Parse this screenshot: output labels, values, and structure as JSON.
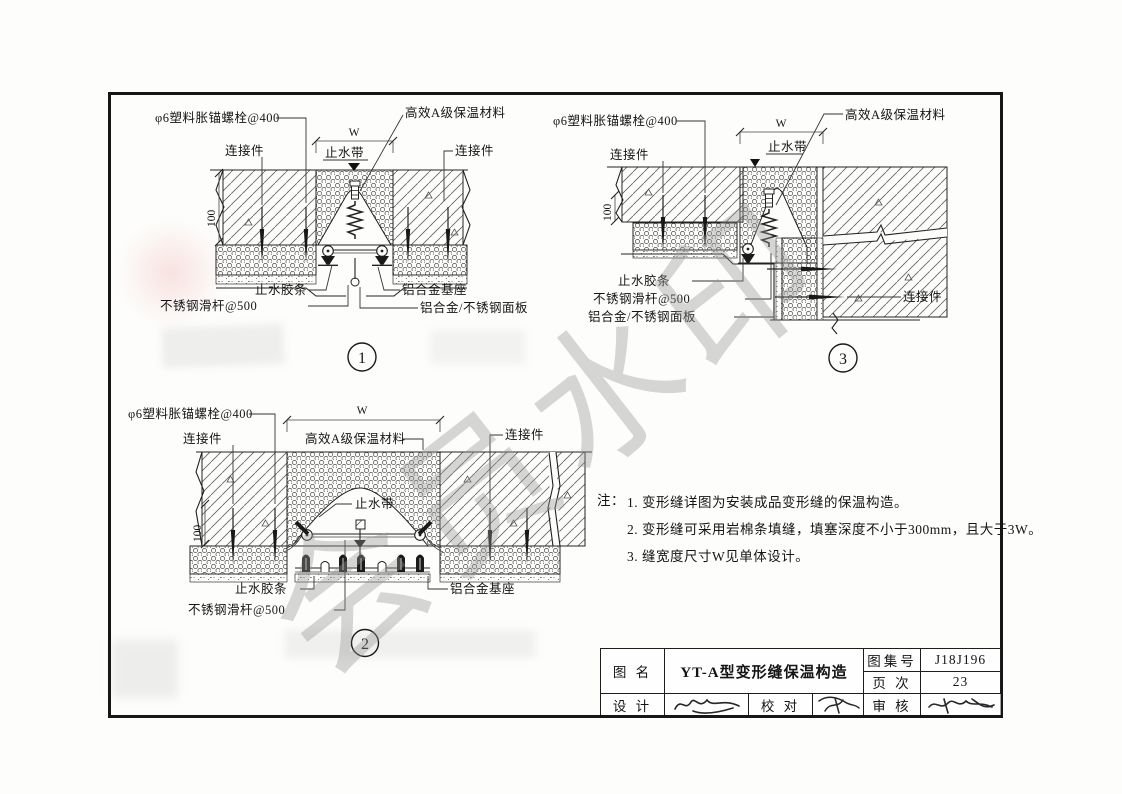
{
  "watermark_text": "会员水印",
  "labels": {
    "anchor_bolt": "φ6塑料胀锚螺栓@400",
    "connector": "连接件",
    "insulation": "高效A级保温材料",
    "waterstop_band": "止水带",
    "seal_strip": "止水胶条",
    "slide_rod": "不锈钢滑杆@500",
    "alu_base": "铝合金基座",
    "alu_panel": "铝合金/不锈钢面板",
    "dim_w": "W",
    "dim_100": "100"
  },
  "details": {
    "d1": {
      "number": "1"
    },
    "d2": {
      "number": "2"
    },
    "d3": {
      "number": "3"
    }
  },
  "notes": {
    "prefix": "注：",
    "items": [
      "1. 变形缝详图为安装成品变形缝的保温构造。",
      "2. 变形缝可采用岩棉条填缝，填塞深度不小于300mm，且大于3W。",
      "3. 缝宽度尺寸W见单体设计。"
    ]
  },
  "title_block": {
    "name_label": "图 名",
    "name_value": "YT-A型变形缝保温构造",
    "atlas_label": "图集号",
    "atlas_value": "J18J196",
    "page_label": "页 次",
    "page_value": "23",
    "design_label": "设 计",
    "proof_label": "校 对",
    "review_label": "审 核"
  }
}
